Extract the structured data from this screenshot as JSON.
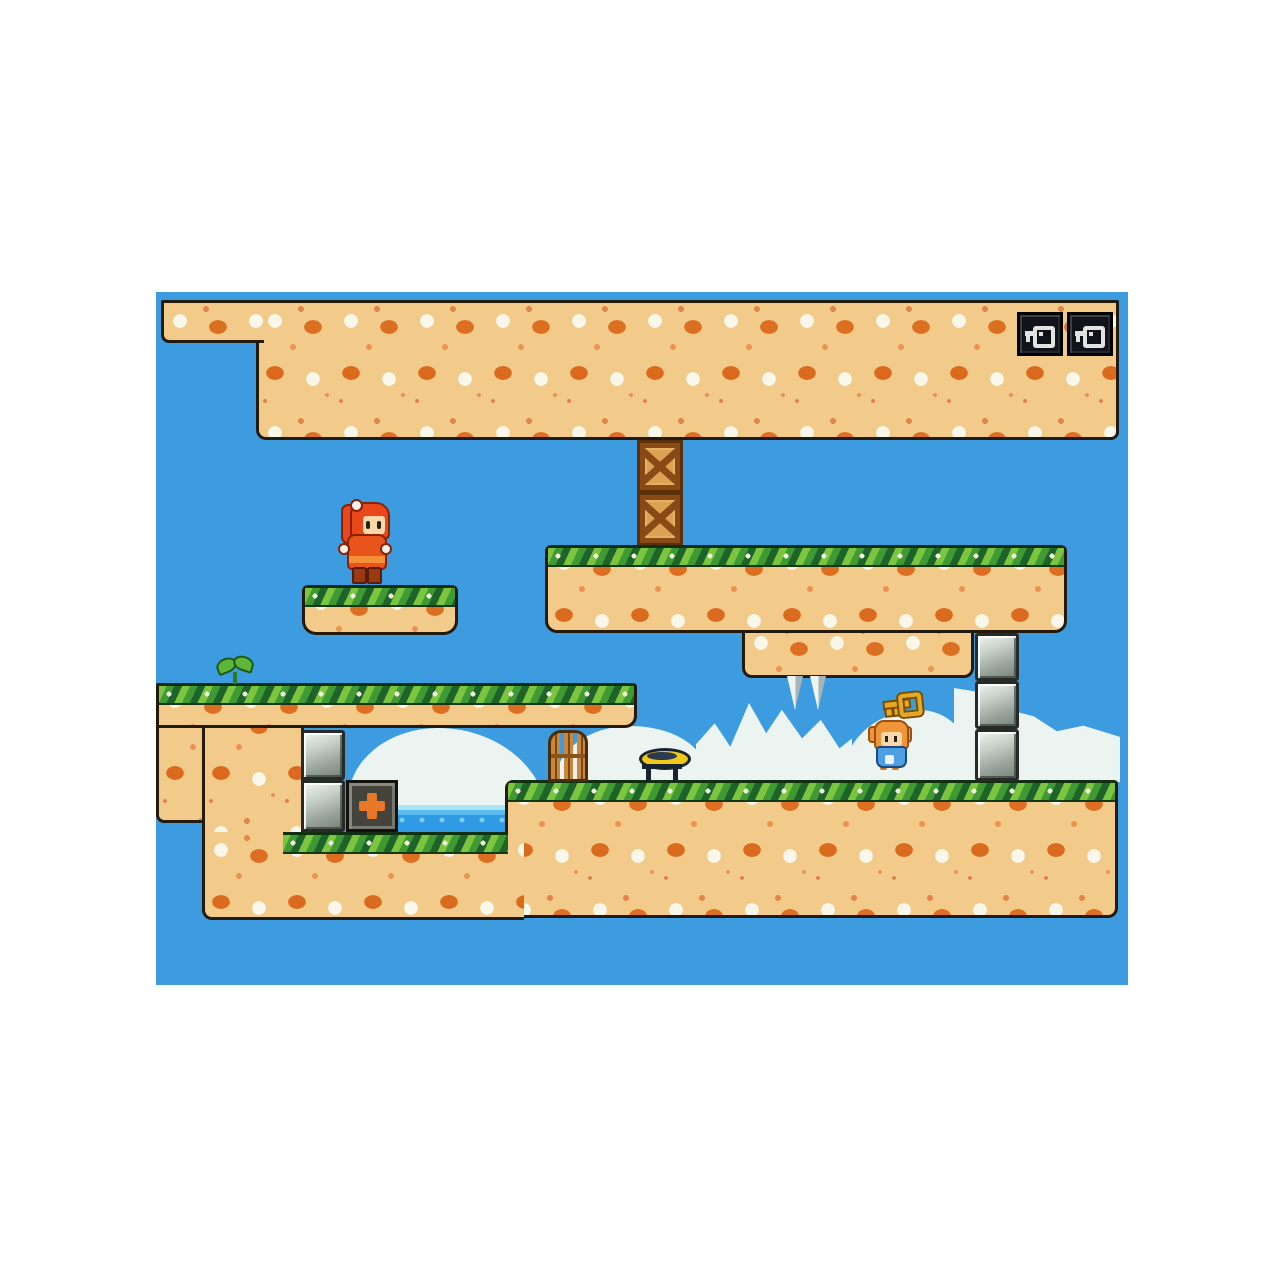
{
  "app": {
    "description": "2D pixel-art platformer game screenshot",
    "visible_text": ""
  },
  "colors": {
    "sky": "#3D9BE0",
    "sand": "#F2CB8B",
    "outline": "#241A0E",
    "grass_dark": "#1E642A",
    "grass_light": "#7CC63F",
    "cloud": "#ECF4F2",
    "water": "#2E9BE4",
    "stone": "#97A29A",
    "crate": "#DCA254",
    "cross": "#E87828",
    "key_gold": "#E8A820",
    "key_silver": "#E2E2E2",
    "hud_box": "#12121A",
    "player_hair": "#E8481C",
    "player_dress": "#E8551A",
    "npc_hair": "#F0953A",
    "npc_dress": "#4E9EE4"
  },
  "viewport": {
    "x": 156,
    "y": 292,
    "w": 972,
    "h": 693
  },
  "hud": {
    "key_slots": [
      {
        "icon": "key-icon"
      },
      {
        "icon": "key-icon"
      }
    ]
  },
  "level": {
    "entities": [
      {
        "name": "cloud-alcove",
        "type": "cloud",
        "variant": "cl-dome",
        "x": 192,
        "y": 436,
        "w": 200,
        "h": 104,
        "z": 1
      },
      {
        "name": "cloud-gate",
        "type": "cloud",
        "variant": "cl-round",
        "x": 399,
        "y": 434,
        "w": 150,
        "h": 56,
        "z": 1
      },
      {
        "name": "cloud-peaks",
        "type": "cloud",
        "variant": "cl-peaks",
        "x": 540,
        "y": 406,
        "w": 156,
        "h": 84,
        "z": 1
      },
      {
        "name": "cloud-mid",
        "type": "cloud",
        "variant": "cl-round2",
        "x": 688,
        "y": 418,
        "w": 126,
        "h": 72,
        "z": 1
      },
      {
        "name": "cloud-right",
        "type": "cloud",
        "variant": "cl-slope",
        "x": 798,
        "y": 396,
        "w": 166,
        "h": 94,
        "z": 1
      },
      {
        "name": "left-wall-upper",
        "type": "dirt",
        "variant": "r-wall",
        "x": 0,
        "y": 408,
        "w": 148,
        "h": 123,
        "z": 2
      },
      {
        "name": "left-wall-lower",
        "type": "dirt",
        "variant": "",
        "x": 46,
        "y": 408,
        "w": 102,
        "h": 140,
        "z": 2
      },
      {
        "name": "water-pool",
        "type": "water",
        "variant": "",
        "x": 240,
        "y": 513,
        "w": 112,
        "h": 30,
        "z": 3
      },
      {
        "name": "crate-top",
        "type": "crate",
        "variant": "",
        "x": 481,
        "y": 148,
        "w": 46,
        "h": 53,
        "z": 3
      },
      {
        "name": "crate-bottom",
        "type": "crate",
        "variant": "",
        "x": 481,
        "y": 200,
        "w": 46,
        "h": 54,
        "z": 3
      },
      {
        "name": "mid-platform-extension",
        "type": "dirt",
        "variant": "r-ext",
        "x": 586,
        "y": 330,
        "w": 232,
        "h": 56,
        "z": 3
      },
      {
        "name": "spike-left",
        "type": "spike",
        "variant": "",
        "x": 629,
        "y": 384,
        "w": 20,
        "h": 34,
        "z": 4
      },
      {
        "name": "spike-right",
        "type": "spike",
        "variant": "",
        "x": 652,
        "y": 384,
        "w": 20,
        "h": 34,
        "z": 4
      },
      {
        "name": "top-ceiling",
        "type": "dirt",
        "variant": "r-ceiling",
        "x": 100,
        "y": 8,
        "w": 863,
        "h": 140,
        "z": 4
      },
      {
        "name": "mid-platform",
        "type": "grass-platform",
        "variant": "r-mid",
        "x": 389,
        "y": 253,
        "w": 522,
        "h": 88,
        "z": 4
      },
      {
        "name": "small-floating-platform",
        "type": "grass-platform",
        "variant": "r-small",
        "x": 146,
        "y": 293,
        "w": 156,
        "h": 50,
        "z": 4
      },
      {
        "name": "top-ceiling-ledge",
        "type": "dirt",
        "variant": "r-ledge",
        "x": 5,
        "y": 8,
        "w": 103,
        "h": 43,
        "z": 5
      },
      {
        "name": "left-shelf",
        "type": "grass-platform",
        "variant": "r-shelf",
        "x": 0,
        "y": 391,
        "w": 481,
        "h": 45,
        "z": 5
      },
      {
        "name": "main-ground",
        "type": "grass-platform",
        "variant": "r-ground",
        "x": 349,
        "y": 488,
        "w": 613,
        "h": 138,
        "z": 5
      },
      {
        "name": "alcove-floor",
        "type": "grass-platform",
        "variant": "r-floor",
        "x": 46,
        "y": 540,
        "w": 322,
        "h": 88,
        "z": 6,
        "grass": {
          "x": 78,
          "w": 225
        }
      },
      {
        "name": "stone-block-column-1",
        "type": "stone",
        "variant": "",
        "x": 819,
        "y": 341,
        "w": 44,
        "h": 48,
        "z": 7
      },
      {
        "name": "stone-block-column-2",
        "type": "stone",
        "variant": "",
        "x": 819,
        "y": 389,
        "w": 44,
        "h": 48,
        "z": 7
      },
      {
        "name": "stone-block-column-3",
        "type": "stone",
        "variant": "",
        "x": 819,
        "y": 437,
        "w": 44,
        "h": 52,
        "z": 7
      },
      {
        "name": "stone-block-alcove-1",
        "type": "stone",
        "variant": "",
        "x": 145,
        "y": 438,
        "w": 44,
        "h": 50,
        "z": 7
      },
      {
        "name": "stone-block-alcove-2",
        "type": "stone",
        "variant": "",
        "x": 145,
        "y": 488,
        "w": 44,
        "h": 52,
        "z": 7
      },
      {
        "name": "health-box",
        "type": "crossbox",
        "variant": "",
        "x": 190,
        "y": 488,
        "w": 52,
        "h": 52,
        "z": 7
      },
      {
        "name": "gate",
        "type": "gate",
        "variant": "",
        "x": 392,
        "y": 438,
        "w": 40,
        "h": 52,
        "z": 7
      },
      {
        "name": "trampoline",
        "type": "tramp",
        "variant": "",
        "x": 482,
        "y": 454,
        "w": 52,
        "h": 36,
        "z": 7
      },
      {
        "name": "plant-sprout",
        "type": "plant",
        "variant": "",
        "x": 60,
        "y": 364,
        "w": 38,
        "h": 28,
        "z": 7
      },
      {
        "name": "key-item",
        "type": "goldkey",
        "variant": "",
        "x": 727,
        "y": 402,
        "w": 40,
        "h": 24,
        "z": 8
      },
      {
        "name": "npc-character",
        "type": "npc",
        "variant": "",
        "x": 712,
        "y": 428,
        "w": 44,
        "h": 50,
        "z": 8
      },
      {
        "name": "player-character",
        "type": "player",
        "variant": "",
        "x": 183,
        "y": 204,
        "w": 52,
        "h": 90,
        "z": 8
      },
      {
        "name": "hud-key-icon-1",
        "type": "hudkey",
        "variant": "",
        "x": 861,
        "y": 20,
        "w": 46,
        "h": 44,
        "z": 9
      },
      {
        "name": "hud-key-icon-2",
        "type": "hudkey",
        "variant": "",
        "x": 911,
        "y": 20,
        "w": 46,
        "h": 44,
        "z": 9
      }
    ]
  }
}
